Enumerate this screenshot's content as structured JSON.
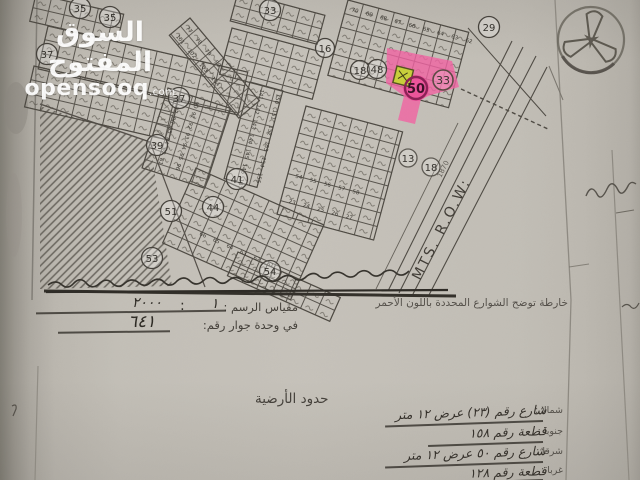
{
  "watermark": {
    "title": "السوق المفتوح",
    "domain_name": "opensooq",
    "domain_tld": ".com"
  },
  "map": {
    "row_label": "MTS. R.O.W:",
    "dim_mark": "1870",
    "block_circles": [
      "35",
      "35",
      "33",
      "29",
      "37",
      "37",
      "39",
      "41",
      "44",
      "51",
      "53",
      "54",
      "16",
      "18",
      "48",
      "13",
      "18"
    ],
    "highlight": {
      "street_circle": "50",
      "block_circle": "33"
    },
    "parcel_rows": {
      "tr_row1": "70 69 68 67 66 65 64 63 62",
      "center_col1": "141 142 143 144 145 146 147",
      "center_col2": "150 151 152 153 154 155",
      "mid_row1": "54 55 56 57 58",
      "mid_row2": "23 24 25 26 27",
      "ladder_col1": "77 78 79 80",
      "ladder_col2": "101 102 103 104",
      "bc_row1": "66 65 64 63 62 61",
      "lm_col1": "89 87 86 85 84 83 81",
      "lm_col2": "90 91 92 93 94 95 96"
    },
    "colors": {
      "street_highlight": "#ee5ea2",
      "plot_highlight": "#c9d03b",
      "ink": "#4a463f"
    }
  },
  "scale_section": {
    "note_red_streets": "خارطة توضح الشوارع المحددة باللون الأحمر",
    "scale_label": "مقياس الرسم :",
    "scale_numerator": "١",
    "scale_separator": ":",
    "scale_denominator": "٢٠٠٠",
    "unit_label": "في وحدة جوار رقم:",
    "unit_value": "٦٤١"
  },
  "boundaries": {
    "title": "حدود الأرضية",
    "rows": [
      {
        "label": "شمالا :",
        "value": "شارع رقم (٢٣) عرض ١٢ متر"
      },
      {
        "label": "جنوبا :",
        "value": "قطعة رقم ١٥٨"
      },
      {
        "label": "شرقا :",
        "value": "شارع رقم ٥٠ عرض ١٢ متر"
      },
      {
        "label": "غربا :",
        "value": "قطعة رقم ١٢٨"
      }
    ]
  }
}
